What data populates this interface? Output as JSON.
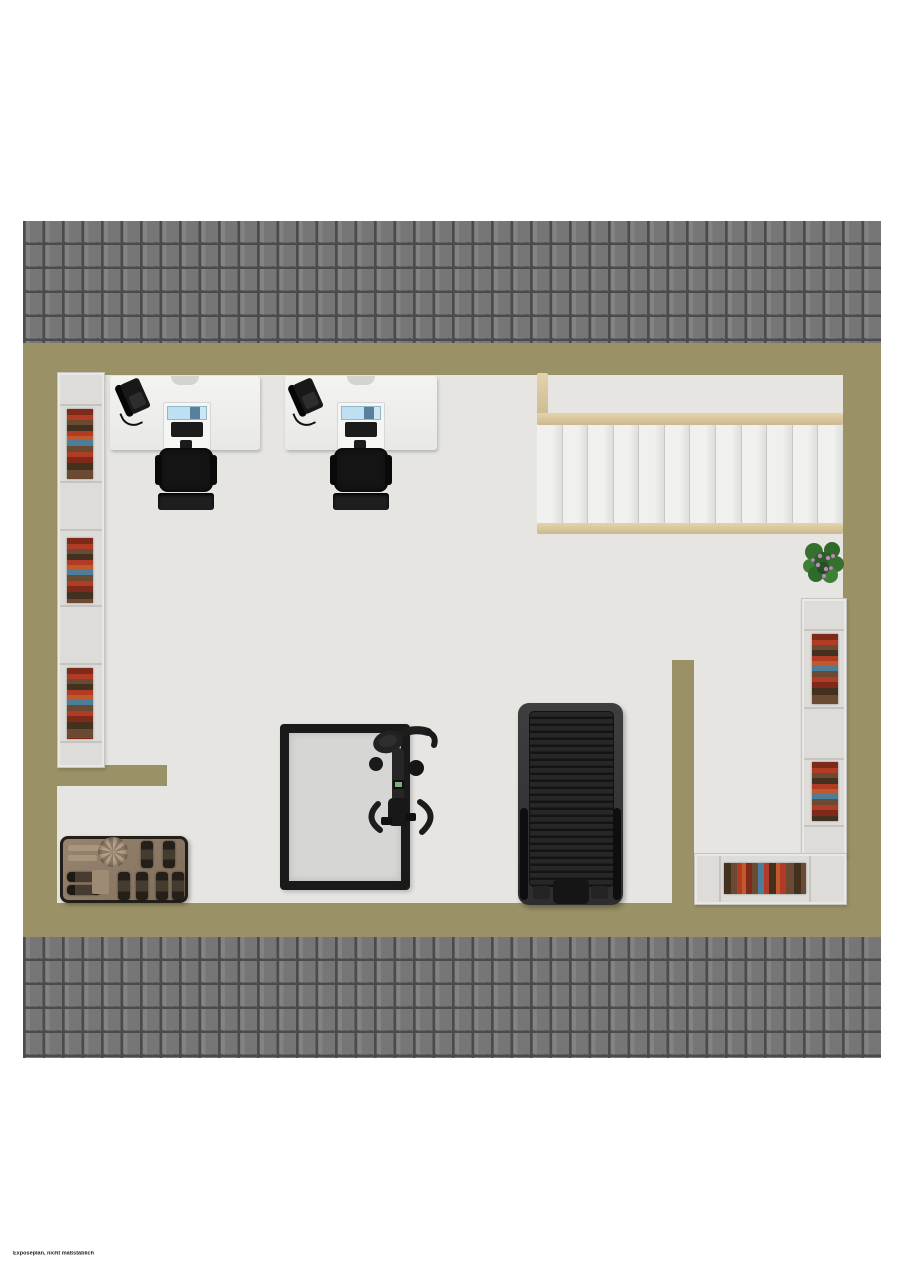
{
  "disclaimer": "Exposeplan, nicht maßstäblich",
  "colors": {
    "page-bg": "#ffffff",
    "wall": "#9a9166",
    "floor": "#e6e5e2",
    "roof-tile": "#767676",
    "roof-line": "#4b4b4b",
    "roof-hilite": "#838383",
    "shelf-bg": "#dddcd9",
    "shelf-border": "#c6c4c0",
    "wood-light": "#e3d3ac",
    "wood-dark": "#ccb98e",
    "screen-blue": "#bfe0f0",
    "book-red": "#b23b25",
    "book-darkred": "#7e2a1a",
    "book-brown": "#6b4a33",
    "book-darkbrown": "#43301f",
    "book-blue": "#4e7d99",
    "book-orange": "#c3592a",
    "plant-green": "#35702f",
    "plant-flower": "#c583c0"
  },
  "plan": {
    "type": "floor-plan",
    "staircase": {
      "steps": 12
    },
    "furniture": [
      {
        "name": "desk-workstation",
        "count": 2,
        "items": [
          "telephone",
          "monitor",
          "keyboard",
          "mouse"
        ]
      },
      {
        "name": "office-chair",
        "count": 2
      },
      {
        "name": "bookshelf",
        "count": 3
      },
      {
        "name": "staircase",
        "count": 1
      },
      {
        "name": "potted-plant",
        "count": 1
      },
      {
        "name": "trampoline-mat",
        "count": 1
      },
      {
        "name": "exercise-bike",
        "count": 1
      },
      {
        "name": "treadmill",
        "count": 1
      },
      {
        "name": "dumbbell-rack",
        "count": 1
      }
    ]
  }
}
